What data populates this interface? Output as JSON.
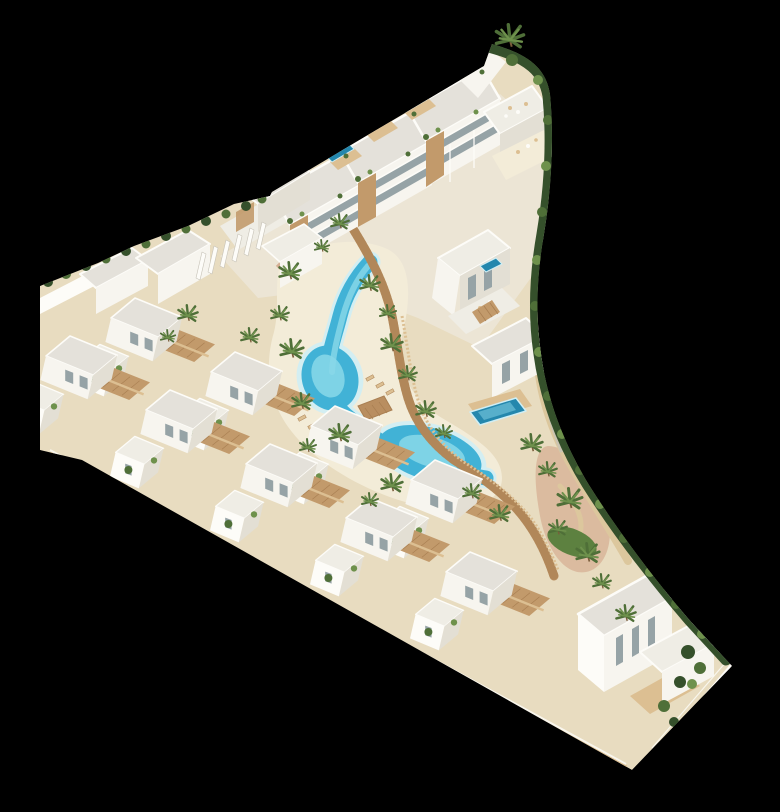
{
  "image": {
    "width": 780,
    "height": 780,
    "caption": "Aerial 3D architectural rendering of a white Mediterranean residential complex: an apartment block with rooftop plunge pools at the top, two echelon rows of cubic villas along the lower left, a winding turquoise lagoon pool with sandy beaches, a timber boardwalk, palm trees, green hedge borders and a landscaped garden, all on a solid black background."
  },
  "colors": {
    "background": "#000000",
    "sand": "#e8dcc0",
    "sand_light": "#f3ecd8",
    "sand_path": "#dcc79d",
    "terracotta": "#cfa183",
    "wall": "#f7f5ef",
    "wall_light": "#fdfcf8",
    "wall_shade": "#e3dfd4",
    "wall_dark": "#c7c3b8",
    "roof": "#e4e1da",
    "roof_light": "#efede5",
    "glass": "#96a3a6",
    "wood": "#c29a6b",
    "wood_light": "#dcbf92",
    "wood_dark": "#a97f52",
    "boardwalk": "#b98e60",
    "pool": "#41b2d6",
    "pool_light": "#8ad8e9",
    "pool_deep": "#2487ad",
    "pool_edge": "#cfeef5",
    "hedge": "#35502b",
    "leaf": "#4f6f38",
    "leaf_light": "#6e914c",
    "lawn": "#5d8140",
    "trunk": "#7a5c3a",
    "shadow": "rgba(0,0,0,0.22)"
  },
  "scene": {
    "elements": [
      "apartment-building",
      "rooftop-terraces",
      "rooftop-plunge-pools",
      "lagoon-pool",
      "beach",
      "boardwalk",
      "wooden-bridge",
      "sun-loungers",
      "villa-rows",
      "fin-pergola-building",
      "private-pool",
      "palm-trees",
      "hedge-border",
      "garden-path",
      "lawn-patches",
      "perimeter-wall",
      "corner-villa-garden"
    ]
  }
}
